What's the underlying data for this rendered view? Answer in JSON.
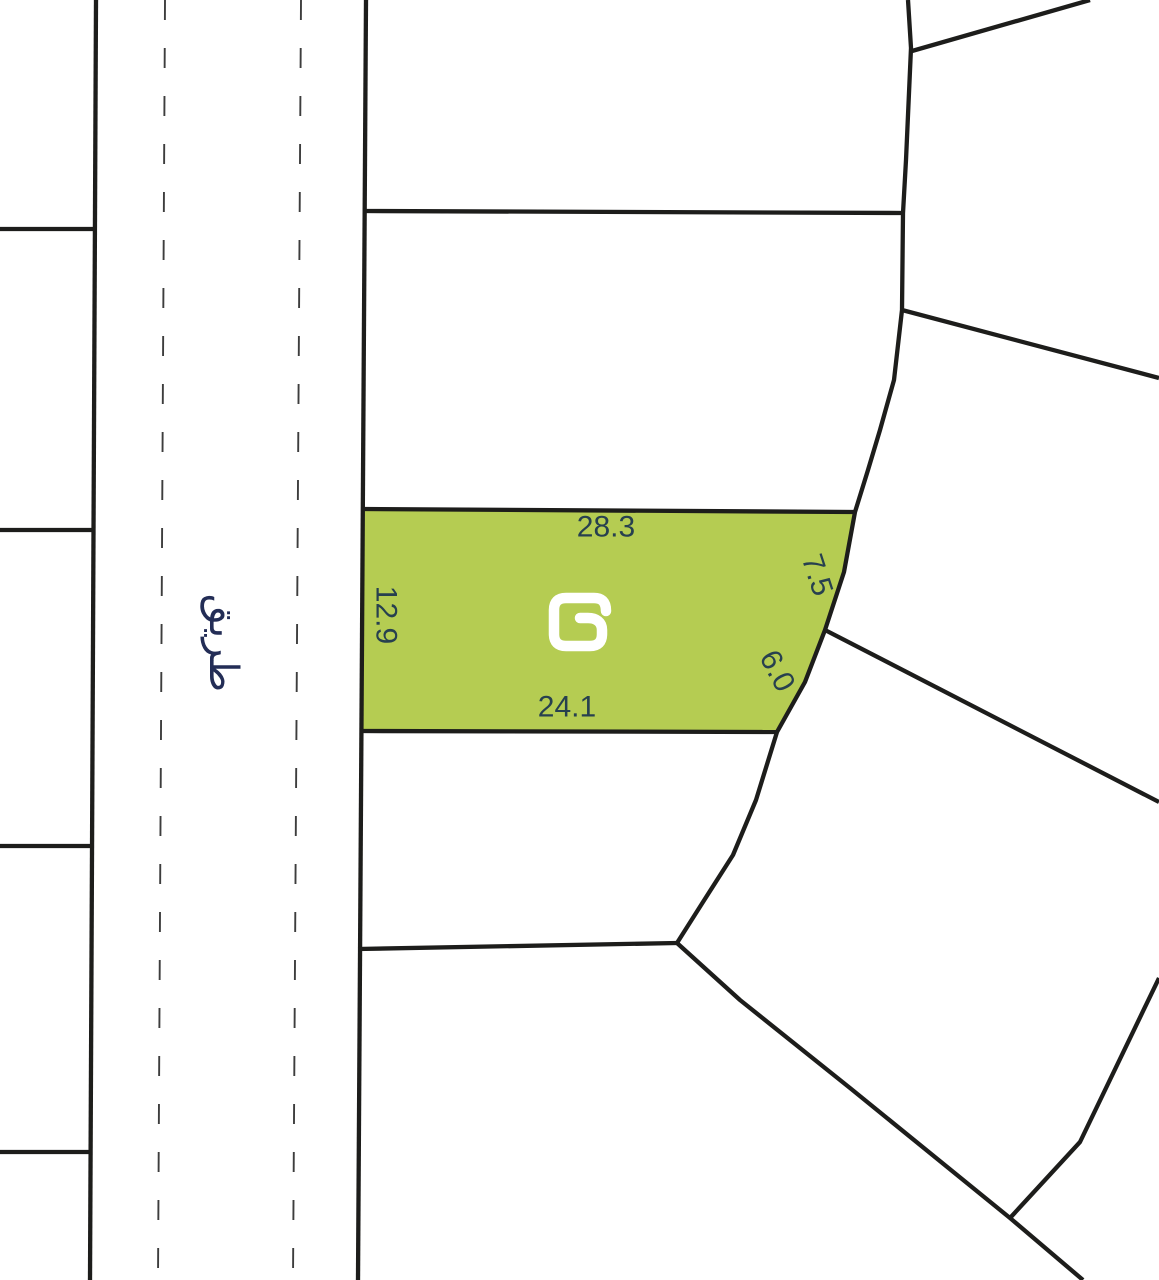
{
  "canvas": {
    "width": 1159,
    "height": 1280,
    "background": "#ffffff"
  },
  "palette": {
    "boundary_line": "#1d1d1b",
    "lane_dash": "#3d3d3d",
    "highlight_fill": "#b5cc52",
    "dimension_text": "#27404f",
    "road_text": "#232d56",
    "logo_stroke": "#ffffff"
  },
  "road": {
    "name": "طريق",
    "label_x": 223,
    "label_y": 643,
    "label_rotation": 90
  },
  "highlight_parcel": {
    "points": "363,509 855,512 844,572 825,630 805,682 777,732 362,731",
    "dimensions": [
      {
        "value": "28.3",
        "x": 606,
        "y": 527,
        "rotation": 0
      },
      {
        "value": "7.5",
        "x": 817,
        "y": 575,
        "rotation": 72
      },
      {
        "value": "6.0",
        "x": 777,
        "y": 671,
        "rotation": 62
      },
      {
        "value": "24.1",
        "x": 567,
        "y": 707,
        "rotation": 0
      },
      {
        "value": "12.9",
        "x": 386,
        "y": 615,
        "rotation": 90
      }
    ],
    "logo": {
      "path": "M 606 611 C 606 601 601 598 594 598 L 566 598 C 558 598 554 602 554 610 L 554 634 C 554 642 558 646 566 646 L 590 646 C 598 646 602 642 602 634 L 602 630 C 602 622 596 618 588 618 L 580 618",
      "stroke_width": 10.5
    }
  },
  "boundaries": {
    "solid": [
      {
        "name": "left-block-east-edge",
        "points": "96,0 90,1280"
      },
      {
        "name": "road-east-edge",
        "points": "366,0 358,1280"
      },
      {
        "name": "left-block-divider-1",
        "points": "0,229 95,229"
      },
      {
        "name": "left-block-divider-2",
        "points": "0,530 93,530"
      },
      {
        "name": "left-block-divider-3",
        "points": "0,846 92,846"
      },
      {
        "name": "left-block-divider-4",
        "points": "0,1152 90,1152"
      },
      {
        "name": "middle-block-divider-north",
        "points": "364,211 903,213"
      },
      {
        "name": "highlight-north-edge",
        "points": "363,509 855,512"
      },
      {
        "name": "highlight-south-edge",
        "points": "362,731 777,732"
      },
      {
        "name": "middle-block-divider-south",
        "points": "358,949 677,943"
      },
      {
        "name": "block-east-arc",
        "points": "908,0 911,48 906,160 903,213 902,310 894,380 880,430 868,470 855,512 844,572 825,630 805,682 777,732 756,800 733,855 703,902 677,943"
      },
      {
        "name": "northeast-diagonal",
        "points": "912,51 1090,0"
      },
      {
        "name": "east-diagonal-upper",
        "points": "902,310 1159,378"
      },
      {
        "name": "east-diagonal-lower",
        "points": "825,630 1159,802"
      },
      {
        "name": "southeast-diagonal",
        "points": "677,943 740,1000 850,1088 1010,1218 1083,1280"
      },
      {
        "name": "southeast-branch",
        "points": "1010,1218 1080,1142 1159,978"
      }
    ],
    "dashed": [
      {
        "name": "lane-divider-west",
        "points": "165,0 158,1280"
      },
      {
        "name": "lane-divider-east",
        "points": "301,0 293,1280"
      }
    ]
  },
  "style": {
    "boundary_width": 4.3,
    "dash_width": 1.9,
    "dash_pattern": "20 28"
  }
}
